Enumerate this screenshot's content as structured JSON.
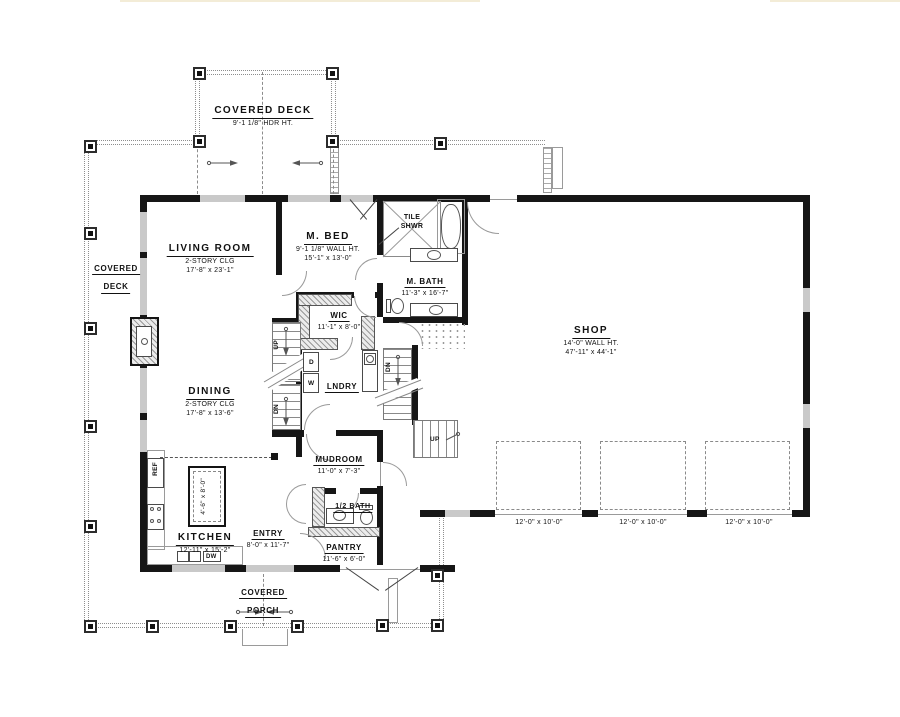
{
  "plan": {
    "rooms": {
      "covered_deck_top": {
        "name": "COVERED DECK",
        "note": "9'-1 1/8\" HDR HT."
      },
      "covered_deck_left": {
        "name1": "COVERED",
        "name2": "DECK"
      },
      "living_room": {
        "name": "LIVING ROOM",
        "note": "2-STORY CLG",
        "size": "17'-8\" x 23'-1\""
      },
      "m_bed": {
        "name": "M. BED",
        "note": "9'-1 1/8\" WALL HT.",
        "size": "15'-1\" x 13'-0\""
      },
      "tile_shwr": {
        "name1": "TILE",
        "name2": "SHWR"
      },
      "m_bath": {
        "name": "M. BATH",
        "size": "11'-3\" x 16'-7\""
      },
      "wic": {
        "name": "WIC",
        "size": "11'-1\" x 8'-0\""
      },
      "shop": {
        "name": "SHOP",
        "note": "14'-0\" WALL HT.",
        "size": "47'-11\" x 44'-1\""
      },
      "dining": {
        "name": "DINING",
        "note": "2-STORY CLG",
        "size": "17'-8\" x 13'-6\""
      },
      "lndry": {
        "name": "LNDRY"
      },
      "mudroom": {
        "name": "MUDROOM",
        "size": "11'-0\" x 7'-3\""
      },
      "kitchen": {
        "name": "KITCHEN",
        "size": "12'-11\" x 15'-2\""
      },
      "island": {
        "size": "4'-6\" x 8'-0\""
      },
      "entry": {
        "name": "ENTRY",
        "size": "8'-0\" x 11'-7\""
      },
      "half_bath": {
        "name": "1/2 BATH"
      },
      "pantry": {
        "name": "PANTRY",
        "size": "11'-6\" x 6'-0\""
      },
      "covered_porch": {
        "name1": "COVERED",
        "name2": "PORCH"
      }
    },
    "appliances": {
      "ref": "REF",
      "dw": "DW",
      "washer": "W",
      "dryer": "D"
    },
    "stairs": {
      "up_main": "UP",
      "dn_main": "DN",
      "dn_shop": "DN",
      "up_shop": "UP"
    },
    "garage_doors": {
      "door1": "12'-0\" x 10'-0\"",
      "door2": "12'-0\" x 10'-0\"",
      "door3": "12'-0\" x 10'-0\""
    },
    "colors": {
      "wall": "#161616",
      "window": "#c9c9c9",
      "rail": "#8e8e8e",
      "top_accent": "#f3ecd7"
    }
  }
}
